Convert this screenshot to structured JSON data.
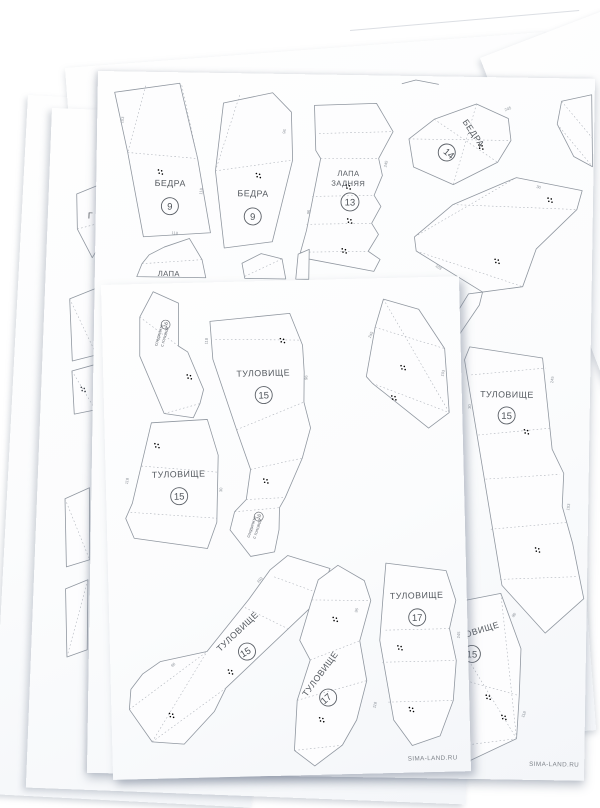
{
  "sheets": {
    "back_pattern": {
      "watermark": "SIMA-LAND.RU",
      "parts": {
        "hips_left": {
          "label": "БЕДРА",
          "number": "9"
        },
        "hips_right": {
          "label": "БЕДРА",
          "number": "9"
        },
        "rear_paw": {
          "label_line1": "ЛАПА",
          "label_line2": "ЗАДНЯЯ",
          "number": "13"
        },
        "hips_small": {
          "label": "БЕДРА",
          "number": "14"
        },
        "paw_cut": {
          "label": "ЛАПА"
        },
        "torso_tall": {
          "label": "ТУЛОВИЩЕ",
          "number": "15"
        },
        "torso_corner": {
          "label": "ТУЛОВИЩЕ",
          "number": "15"
        }
      }
    },
    "front_pattern": {
      "watermark": "SIMA-LAND.RU",
      "parts": {
        "torso_top": {
          "label": "ТУЛОВИЩЕ",
          "number": "15"
        },
        "torso_left": {
          "label": "ТУЛОВИЩЕ",
          "number": "15"
        },
        "torso_diag": {
          "label": "ТУЛОВИЩЕ",
          "number": "15"
        },
        "torso_band": {
          "label": "ТУЛОВИЩЕ",
          "number": "17"
        },
        "torso_strip": {
          "label": "ТУЛОВИЩЕ",
          "number": "17"
        },
        "note_top": {
          "line1": "соедините",
          "line2": "с головой",
          "number": "16"
        },
        "note_bottom": {
          "line1": "соедините",
          "line2": "с головой",
          "number": "16"
        }
      }
    },
    "under_left": {
      "parts": {
        "head_cut": {
          "label": "Г"
        }
      }
    }
  },
  "edge_numbers": [
    "118",
    "245",
    "103",
    "96",
    "30"
  ]
}
